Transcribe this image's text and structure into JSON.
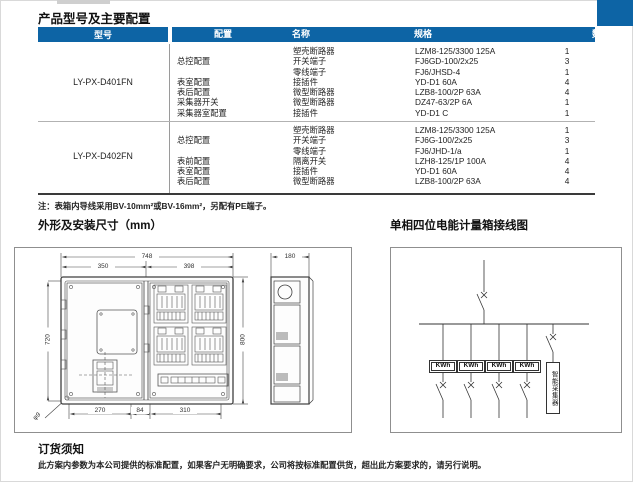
{
  "page": {
    "title": "产品型号及主要配置",
    "note": "注：表箱内导线采用BV-10mm²或BV-16mm²，另配有PE端子。",
    "left_section_title": "外形及安装尺寸（mm）",
    "right_section_title": "单相四位电能计量箱接线图",
    "order_heading": "订货须知",
    "order_text": "此方案内参数为本公司提供的标准配置，如果客户无明确要求，公司将按标准配置供货，超出此方案要求的，请另行说明。"
  },
  "colors": {
    "header_blue": "#0d64a5",
    "line_grey": "#444444"
  },
  "table": {
    "headers": [
      "型号",
      "配置",
      "名称",
      "规格",
      "数量"
    ],
    "groups": [
      {
        "model": "LY-PX-D401FN",
        "rows": [
          {
            "config": "",
            "name": "塑壳断路器",
            "spec": "LZM8-125/3300 125A",
            "qty": "1"
          },
          {
            "config": "总控配置",
            "name": "开关端子",
            "spec": "FJ6GD-100/2x25",
            "qty": "3"
          },
          {
            "config": "",
            "name": "零线端子",
            "spec": "FJ6/JHSD-4",
            "qty": "1"
          },
          {
            "config": "表室配置",
            "name": "接插件",
            "spec": "YD-D1 60A",
            "qty": "4"
          },
          {
            "config": "表后配置",
            "name": "微型断路器",
            "spec": "LZB8-100/2P 63A",
            "qty": "4"
          },
          {
            "config": "采集器开关",
            "name": "微型断路器",
            "spec": "DZ47-63/2P 6A",
            "qty": "1"
          },
          {
            "config": "采集器室配置",
            "name": "接插件",
            "spec": "YD-D1 C",
            "qty": "1"
          }
        ]
      },
      {
        "model": "LY-PX-D402FN",
        "rows": [
          {
            "config": "",
            "name": "塑壳断路器",
            "spec": "LZM8-125/3300 125A",
            "qty": "1"
          },
          {
            "config": "总控配置",
            "name": "开关端子",
            "spec": "FJ6G-100/2x25",
            "qty": "3"
          },
          {
            "config": "",
            "name": "零线端子",
            "spec": "FJ6/JHD-1/a",
            "qty": "1"
          },
          {
            "config": "表前配置",
            "name": "隔离开关",
            "spec": "LZH8-125/1P 100A",
            "qty": "4"
          },
          {
            "config": "表室配置",
            "name": "接插件",
            "spec": "YD-D1 60A",
            "qty": "4"
          },
          {
            "config": "表后配置",
            "name": "微型断路器",
            "spec": "LZB8-100/2P 63A",
            "qty": "4"
          }
        ]
      }
    ]
  },
  "drawing": {
    "dimensions": {
      "total_width": "748",
      "left_width": "350",
      "right_width": "398",
      "depth": "180",
      "height_outer": "800",
      "height_inner": "720",
      "bottom_left": "270",
      "bottom_mid": "84",
      "bottom_right": "310",
      "hole": "φ9"
    }
  },
  "wiring": {
    "meter_labels": [
      "KWh",
      "KWh",
      "KWh",
      "KWh"
    ],
    "collector_label": "智能采集器"
  }
}
